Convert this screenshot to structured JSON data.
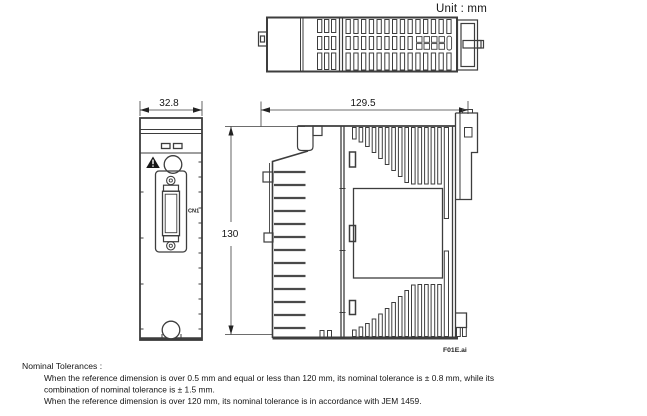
{
  "unit_label": "Unit : mm",
  "file_label": "F01E.ai",
  "dimensions": {
    "front_width": "32.8",
    "depth": "129.5",
    "height": "130"
  },
  "front_view": {
    "connector_label": "CN1"
  },
  "tolerances": {
    "title": "Nominal Tolerances :",
    "lines": [
      "When the reference dimension is over 0.5 mm and equal or less than 120 mm, its nominal tolerance is ± 0.8 mm, while its",
      "combination of nominal tolerance is ± 1.5 mm.",
      "When the reference dimension is over 120 mm, its nominal tolerance is in accordance with JEM 1459."
    ]
  },
  "colors": {
    "line": "#3d3d3d",
    "text": "#151515",
    "background": "#ffffff"
  }
}
